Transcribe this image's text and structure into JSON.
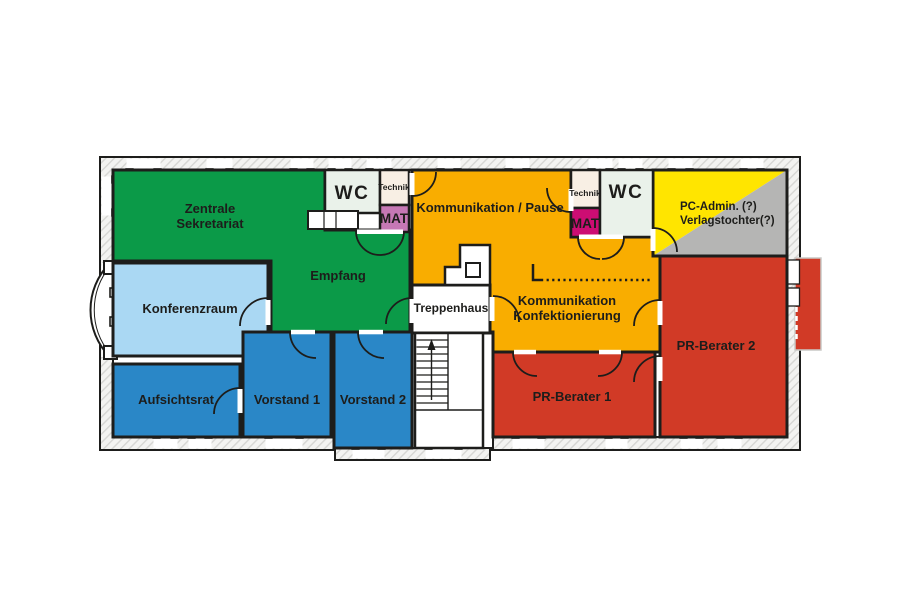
{
  "diagram": {
    "type": "office-floor-plan",
    "rooms": {
      "zentrale_sekretariat": {
        "line1": "Zentrale",
        "line2": "Sekretariat"
      },
      "empfang": {
        "label": "Empfang"
      },
      "konferenzraum": {
        "label": "Konferenzraum"
      },
      "aufsichtsrat": {
        "label": "Aufsichtsrat"
      },
      "vorstand_1": {
        "label": "Vorstand 1"
      },
      "vorstand_2": {
        "label": "Vorstand 2"
      },
      "wc_links": {
        "label": "WC"
      },
      "technik_links": {
        "label": "Technik"
      },
      "mat_links": {
        "label": "MAT"
      },
      "kommunikation_pause": {
        "label": "Kommunikation / Pause"
      },
      "treppenhaus": {
        "label": "Treppenhaus"
      },
      "kommunikation_konfektionierung": {
        "line1": "Kommunikation",
        "line2": "Konfektionierung"
      },
      "technik_rechts": {
        "label": "Technik"
      },
      "mat_rechts": {
        "label": "MAT"
      },
      "wc_rechts": {
        "label": "WC"
      },
      "pc_admin": {
        "line1": "PC-Admin. (?)",
        "line2": "Verlagstochter(?)"
      },
      "pr_berater_1": {
        "label": "PR-Berater 1"
      },
      "pr_berater_2": {
        "label": "PR-Berater 2"
      }
    },
    "colors": {
      "green": "#0b9a48",
      "light_blue": "#aad8f3",
      "blue": "#2a87c7",
      "orange": "#f9ad00",
      "red": "#d13a26",
      "yellow": "#ffe500",
      "gray": "#b5b5b4",
      "magenta": "#cc0d73",
      "violet": "#c678b5",
      "cream": "#f8efe4",
      "mint": "#eaf2ea",
      "white": "#ffffff",
      "wall_line": "#1d1d1b"
    }
  }
}
